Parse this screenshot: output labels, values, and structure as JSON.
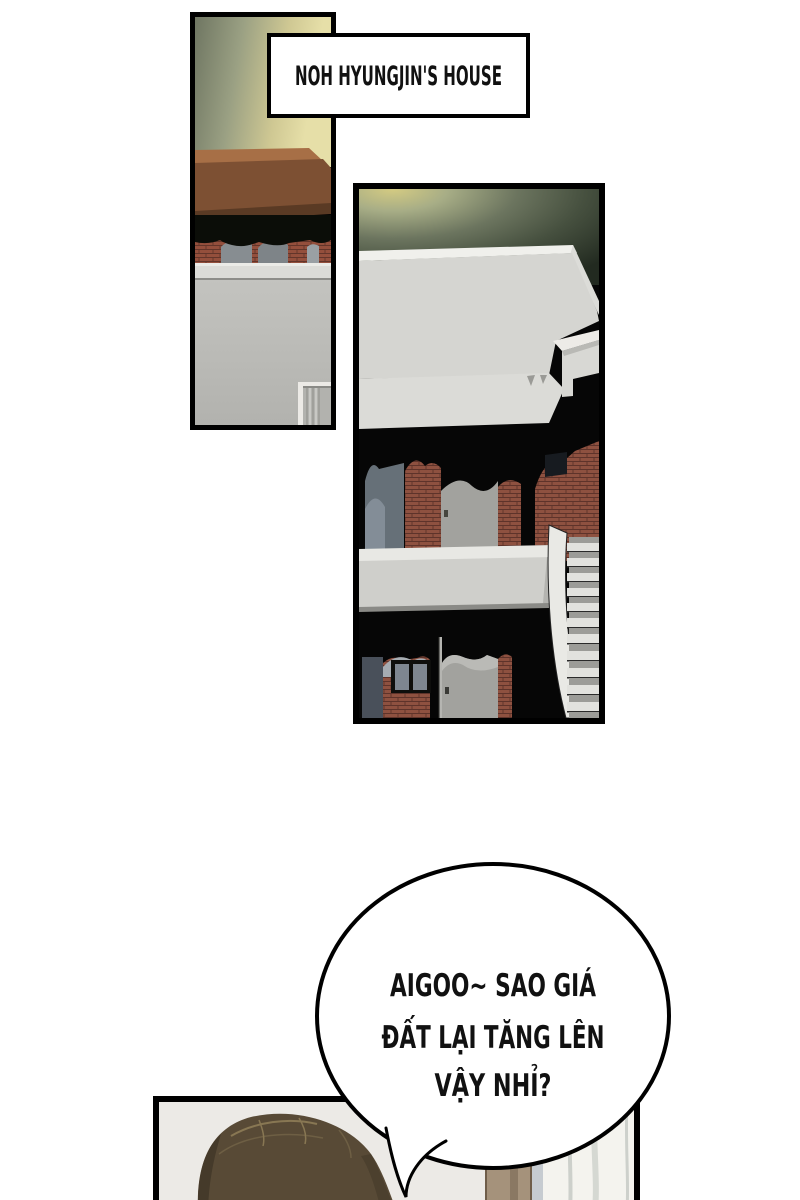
{
  "caption": {
    "text": "NOH HYUNGJIN'S HOUSE"
  },
  "speech_bubble": {
    "lines": [
      "AIGOO~ SAO GIÁ",
      "ĐẤT LẠI TĂNG LÊN",
      "VẬY NHỈ?"
    ]
  },
  "palette": {
    "panel_border": "#000000",
    "glow_yellow": "#e6dfa8",
    "glow_olive": "#6f7662",
    "wood_beam": "#7d5033",
    "brick": "#944f3c",
    "concrete_light": "#d5d5d1",
    "concrete_wall": "#bcbcb8",
    "shadow_black": "#060606",
    "window_glass": "#667078",
    "door_gray": "#a2a29e",
    "stair_tread": "#e2e2de",
    "hair_brown": "#584a36",
    "skin": "#f0d9c3",
    "wood_cabinet": "#a5927b",
    "curtain": "#f4f3ee",
    "room_wall": "#eceae6",
    "bubble_fill": "#ffffff"
  }
}
